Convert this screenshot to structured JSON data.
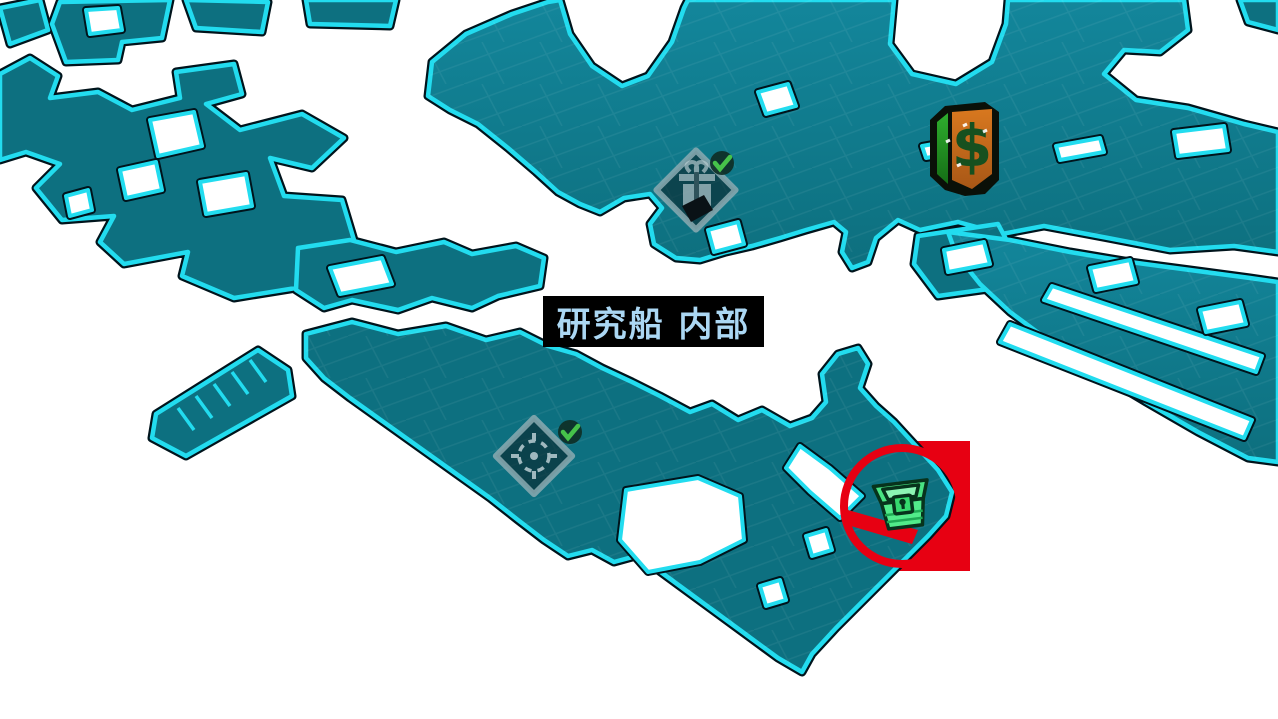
{
  "map": {
    "location_label": "研究船 内部",
    "colors": {
      "background": "#ffffff",
      "map_fill": "#0d7080",
      "map_fill_light": "#13869b",
      "map_border_cyan": "#22dcef",
      "map_border_dark": "#00141c",
      "label_bg": "#000000",
      "label_text": "#abd7f3",
      "highlight_red": "#e70012",
      "check_green": "#46c24a",
      "chest_green": "#4fe886",
      "vending_orange": "#c96a1c",
      "vending_green": "#2fae2e"
    },
    "markers": [
      {
        "name": "gift-challenge-icon",
        "meaning": "collectible drop challenge",
        "status": "completed"
      },
      {
        "name": "crosshair-challenge-icon",
        "meaning": "target challenge",
        "status": "completed"
      },
      {
        "name": "vending-machine-icon",
        "meaning": "vending machine ($)",
        "status": ""
      },
      {
        "name": "treasure-chest-icon",
        "meaning": "red loot chest",
        "status": "highlighted"
      }
    ],
    "annotation": {
      "shape": "red circle and red box",
      "color": "#e70012"
    },
    "dollar_glyph": "$"
  }
}
